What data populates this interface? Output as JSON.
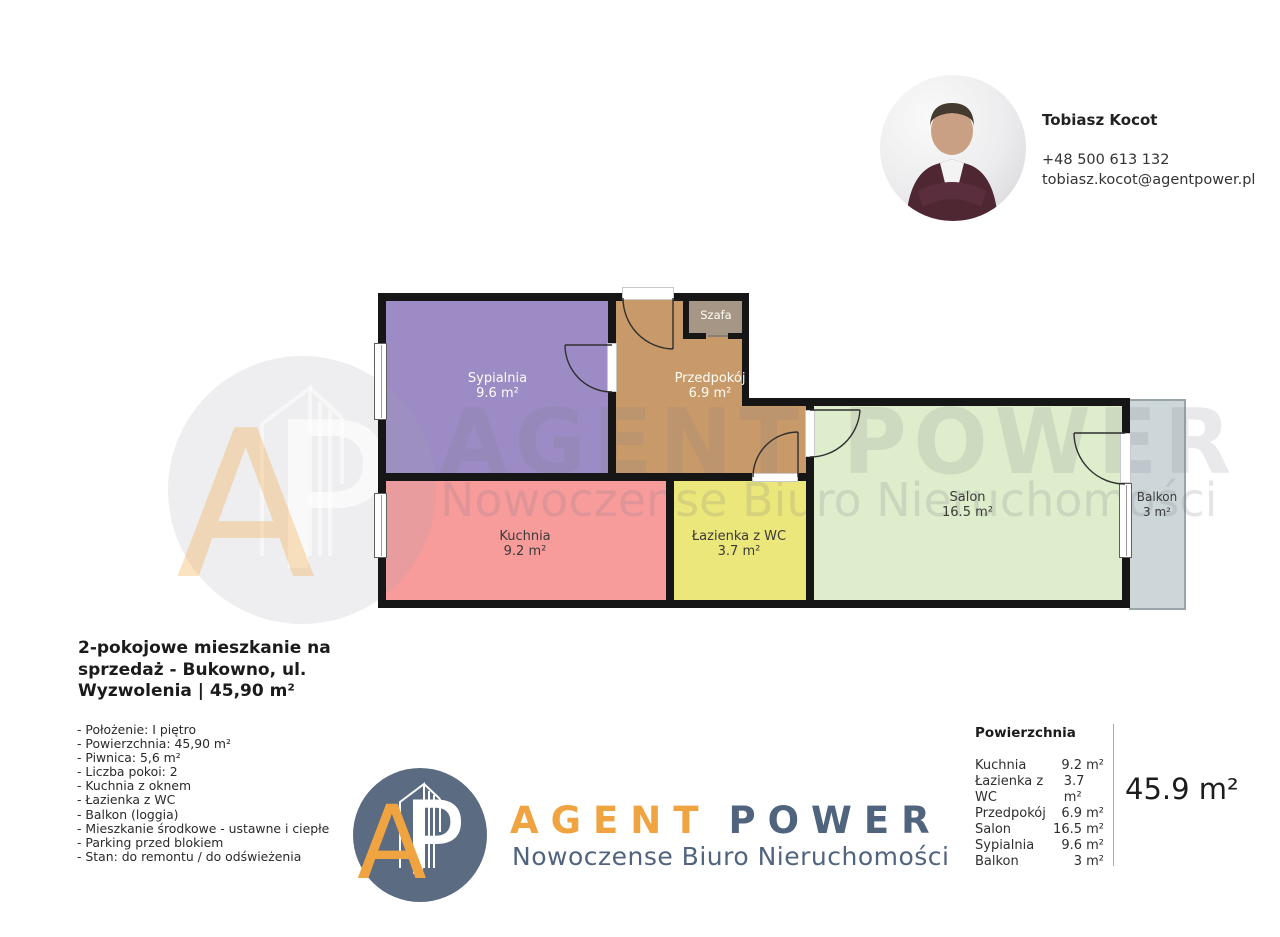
{
  "agent": {
    "name": "Tobiasz Kocot",
    "phone": "+48 500 613 132",
    "email": "tobiasz.kocot@agentpower.pl"
  },
  "floorplan": {
    "rooms": {
      "sypialnia": {
        "label": "Sypialnia",
        "area": "9.6 m²",
        "color": "#9D8BC5"
      },
      "przedpokoj": {
        "label": "Przedpokój",
        "area": "6.9 m²",
        "color": "#C99A69"
      },
      "szafa": {
        "label": "Szafa",
        "color": "#A69685"
      },
      "kuchnia": {
        "label": "Kuchnia",
        "area": "9.2 m²",
        "color": "#F89B9B"
      },
      "lazienka": {
        "label": "Łazienka z WC",
        "area": "3.7 m²",
        "color": "#EBE77A"
      },
      "salon": {
        "label": "Salon",
        "area": "16.5 m²",
        "color": "#DEEDCB"
      },
      "balkon": {
        "label": "Balkon",
        "area": "3 m²",
        "color": "#CDD7DA"
      }
    }
  },
  "watermark": {
    "brand": "AGENT POWER",
    "tagline": "Nowoczense Biuro Nieruchomości"
  },
  "listing": {
    "title_lines": [
      "2-pokojowe mieszkanie na",
      "sprzedaż - Bukowno, ul.",
      "Wyzwolenia | 45,90 m²"
    ],
    "features": [
      "- Położenie: I piętro",
      "- Powierzchnia: 45,90 m²",
      "- Piwnica: 5,6 m²",
      "- Liczba pokoi: 2",
      "- Kuchnia z oknem",
      "- Łazienka z WC",
      "- Balkon (loggia)",
      "- Mieszkanie środkowe - ustawne i ciepłe",
      "- Parking przed blokiem",
      "- Stan: do remontu / do odświeżenia"
    ]
  },
  "logo": {
    "letter_a": "A",
    "letter_p": "P",
    "brand_agent": "AGENT",
    "brand_power": "POWER",
    "tagline": "Nowoczense Biuro Nieruchomości",
    "accent_orange": "#F0A441",
    "slate_blue": "#51647E"
  },
  "summary": {
    "header": "Powierzchnia",
    "rows": [
      {
        "label": "Kuchnia",
        "value": "9.2 m²"
      },
      {
        "label": "Łazienka z WC",
        "value": "3.7 m²"
      },
      {
        "label": "Przedpokój",
        "value": "6.9 m²"
      },
      {
        "label": "Salon",
        "value": "16.5 m²"
      },
      {
        "label": "Sypialnia",
        "value": "9.6 m²"
      },
      {
        "label": "Balkon",
        "value": "3 m²"
      }
    ],
    "total": "45.9 m²"
  }
}
